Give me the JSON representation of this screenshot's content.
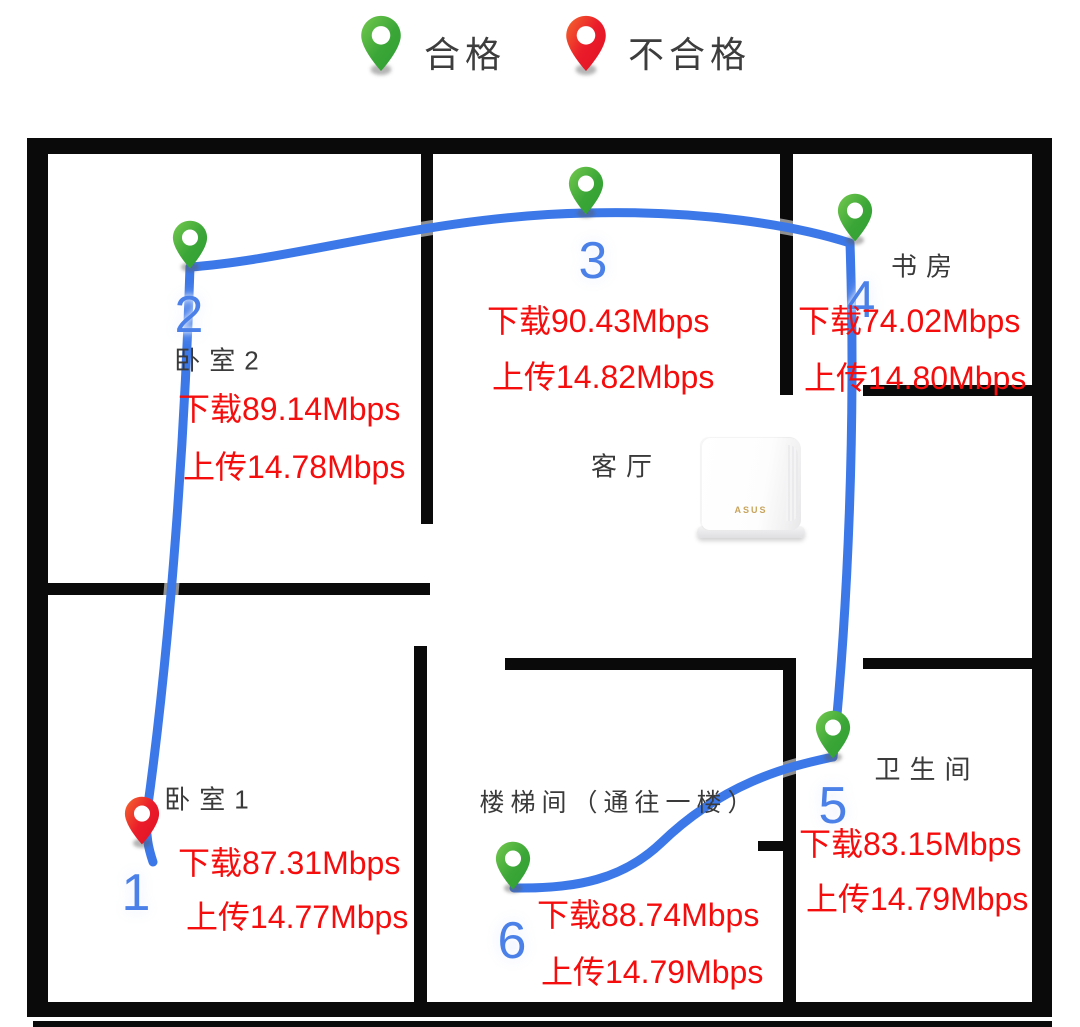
{
  "legend": {
    "pass": {
      "label": "合格",
      "pin_color": "#3aa637"
    },
    "fail": {
      "label": "不合格",
      "pin_color": "#e91429"
    }
  },
  "rooms": [
    {
      "name": "卧室2"
    },
    {
      "name": "书房"
    },
    {
      "name": "客厅"
    },
    {
      "name": "卧室1"
    },
    {
      "name": "楼梯间（通往一楼）"
    },
    {
      "name": "卫生间"
    }
  ],
  "router": {
    "brand": "ASUS"
  },
  "points": [
    {
      "num": "1",
      "status": "fail",
      "download": "下载87.31Mbps",
      "upload": "上传14.77Mbps",
      "room": "卧室1"
    },
    {
      "num": "2",
      "status": "pass",
      "download": "下载89.14Mbps",
      "upload": "上传14.78Mbps",
      "room": "卧室2"
    },
    {
      "num": "3",
      "status": "pass",
      "download": "下载90.43Mbps",
      "upload": "上传14.82Mbps",
      "room": "客厅"
    },
    {
      "num": "4",
      "status": "pass",
      "download": "下载74.02Mbps",
      "upload": "上传14.80Mbps",
      "room": "书房"
    },
    {
      "num": "5",
      "status": "pass",
      "download": "下载83.15Mbps",
      "upload": "上传14.79Mbps",
      "room": "卫生间"
    },
    {
      "num": "6",
      "status": "pass",
      "download": "下载88.74Mbps",
      "upload": "上传14.79Mbps",
      "room": "楼梯间（通往一楼）"
    }
  ],
  "colors": {
    "route_blue": "#3c78e8",
    "number_blue": "#4a80e8",
    "speed_red": "#f50d0d",
    "wall_black": "#0a0a0a",
    "pin_green": "#3aa637",
    "pin_red": "#e91429"
  }
}
